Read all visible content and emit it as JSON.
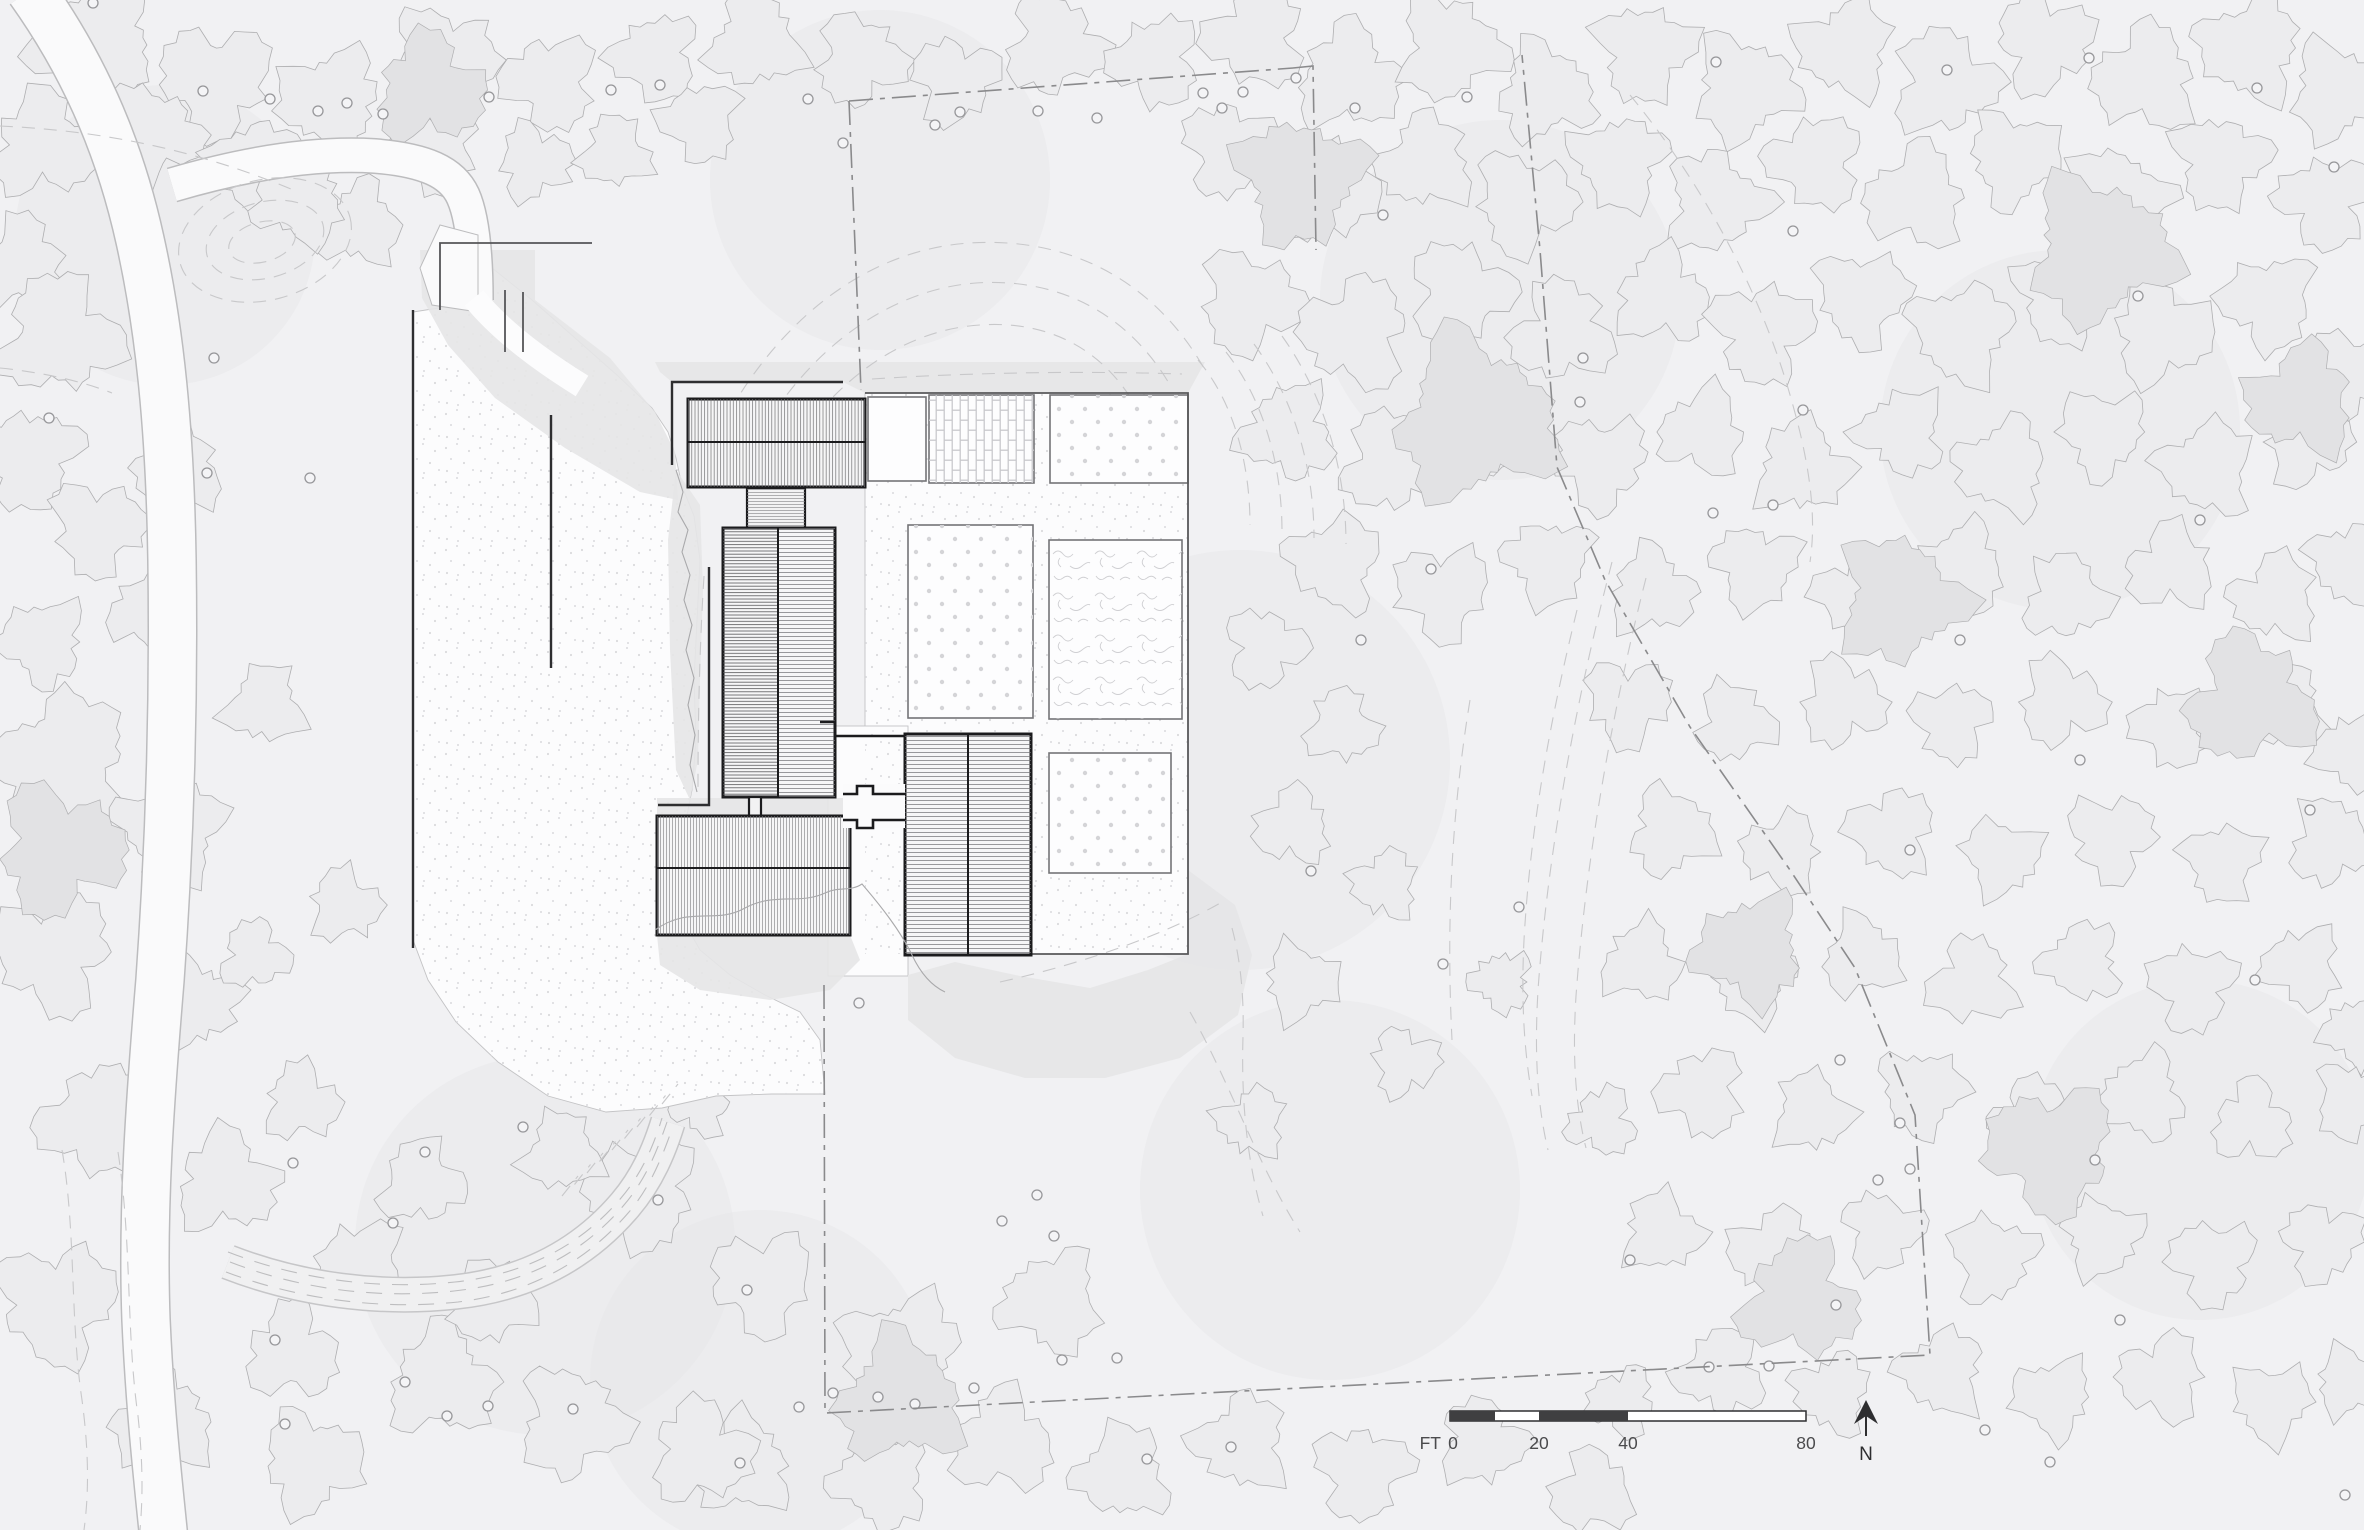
{
  "scale_bar": {
    "unit_label": "FT",
    "ticks": [
      {
        "label": "0"
      },
      {
        "label": "20"
      },
      {
        "label": "40"
      },
      {
        "label": "80"
      }
    ]
  },
  "north_indicator": {
    "label": "N"
  },
  "palette": {
    "background": "#f1f1f3",
    "tree_fill_light": "#ececee",
    "tree_fill_mid": "#e7e7e9",
    "tree_fill_deep": "#e2e2e4",
    "tree_outline": "#aeaeb0",
    "clearing_fill": "#fcfcfd",
    "road_fill": "#fafafb",
    "road_edge": "#bcbcbe",
    "slope_fill": "#e5e5e7",
    "contour": "#c8c8ca",
    "property_boundary": "#8a8a8c",
    "building_outline": "#1b1b1d",
    "building_fill": "#f6f6f7",
    "plot_border": "#747477",
    "label_ink": "#3c3c3e"
  }
}
